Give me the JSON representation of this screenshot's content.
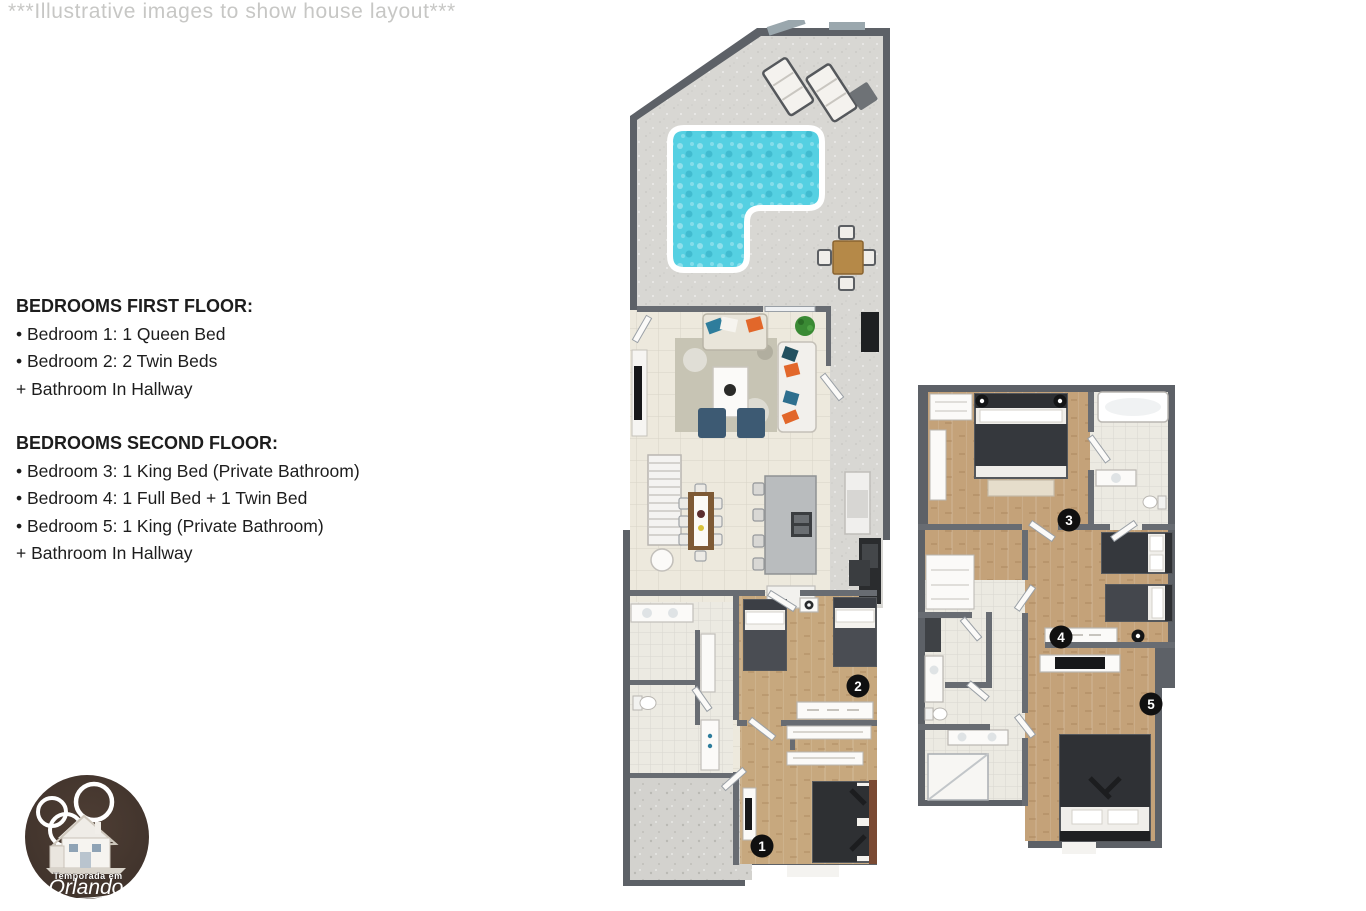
{
  "watermark": "***Illustrative images to show house layout***",
  "info": {
    "first_floor": {
      "title": "BEDROOMS FIRST FLOOR:",
      "items": [
        "• Bedroom 1: 1 Queen Bed",
        "• Bedroom 2: 2 Twin Beds",
        "+ Bathroom In Hallway"
      ]
    },
    "second_floor": {
      "title": "BEDROOMS SECOND FLOOR:",
      "items": [
        "• Bedroom 3: 1 King Bed (Private Bathroom)",
        "• Bedroom 4: 1 Full Bed + 1 Twin Bed",
        "• Bedroom 5: 1 King (Private Bathroom)",
        "+ Bathroom In Hallway"
      ]
    }
  },
  "floorplans": {
    "first": {
      "badges": [
        "1",
        "2"
      ]
    },
    "second": {
      "badges": [
        "3",
        "4",
        "5"
      ]
    }
  },
  "logo": {
    "line1": "Temporada em",
    "line2": "Orlando"
  },
  "colors": {
    "wall": "#5d6167",
    "partition": "#686c72",
    "floor_tile": "#ede9dd",
    "floor_wood": "#c7a87e",
    "bath_tile": "#eceae2",
    "patio": "#d8d7d3",
    "pool_water": "#55d0e2",
    "badge": "#101010",
    "watermark_text": "#c7c7c5",
    "body_text": "#1d1d1d",
    "logo_bg": "#463830",
    "accent_orange": "#e2672a",
    "accent_blue": "#2e7d9c",
    "ottoman_navy": "#3d5a73"
  }
}
